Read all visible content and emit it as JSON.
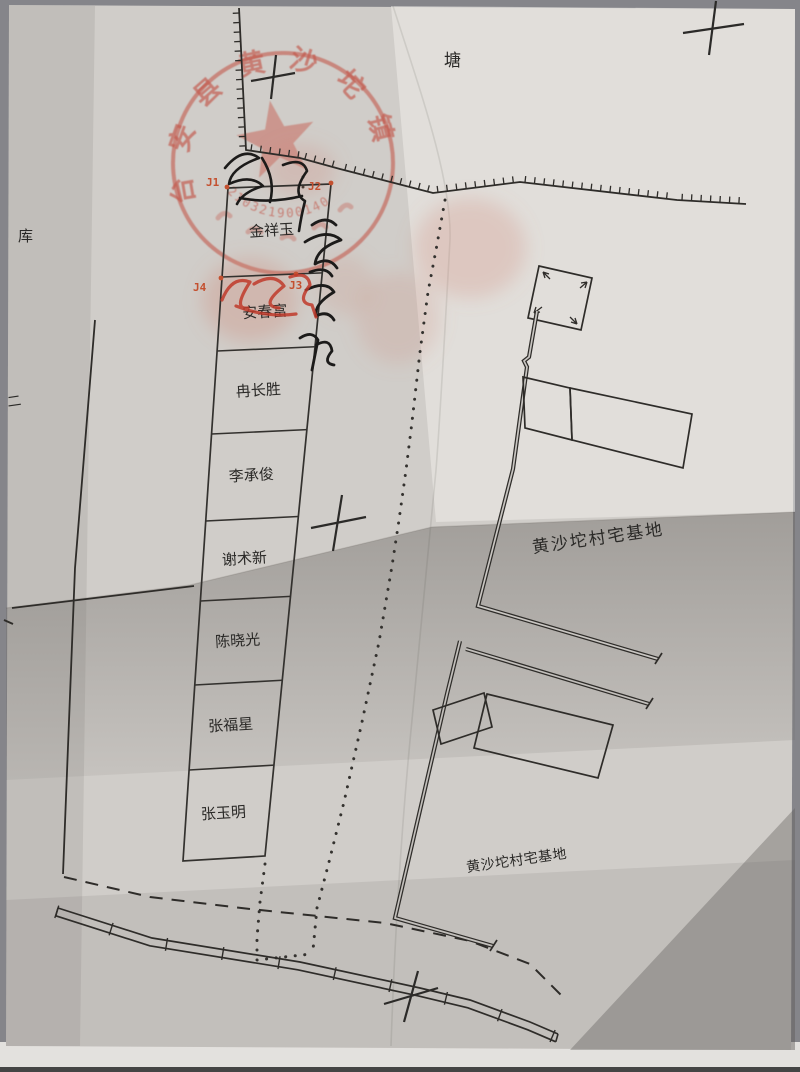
{
  "map": {
    "terrain_labels": {
      "pond": "塘",
      "reservoir": "库",
      "marker_two": "二"
    },
    "area_labels": {
      "homestead_upper": "黄沙坨村宅基地",
      "homestead_lower": "黄沙坨村宅基地"
    },
    "parcel_owners": [
      "金祥玉",
      "安春富",
      "冉长胜",
      "李承俊",
      "谢术新",
      "陈晓光",
      "张福星",
      "张玉明"
    ],
    "corner_labels": {
      "j1": "J1",
      "j2": "J2",
      "j3": "J3",
      "j4": "J4"
    }
  },
  "seal": {
    "arc_text": "台安县黄沙坨镇",
    "code": "210321900140"
  },
  "handwriting": {
    "signature_in_box": "安春富",
    "signature_vertical": "安春富"
  },
  "colors": {
    "paper": "#d0cdc9",
    "ink": "#2e2c29",
    "label_red": "#c4502f",
    "seal_red": "#bf3a2c",
    "photo_background": "#85858a"
  }
}
